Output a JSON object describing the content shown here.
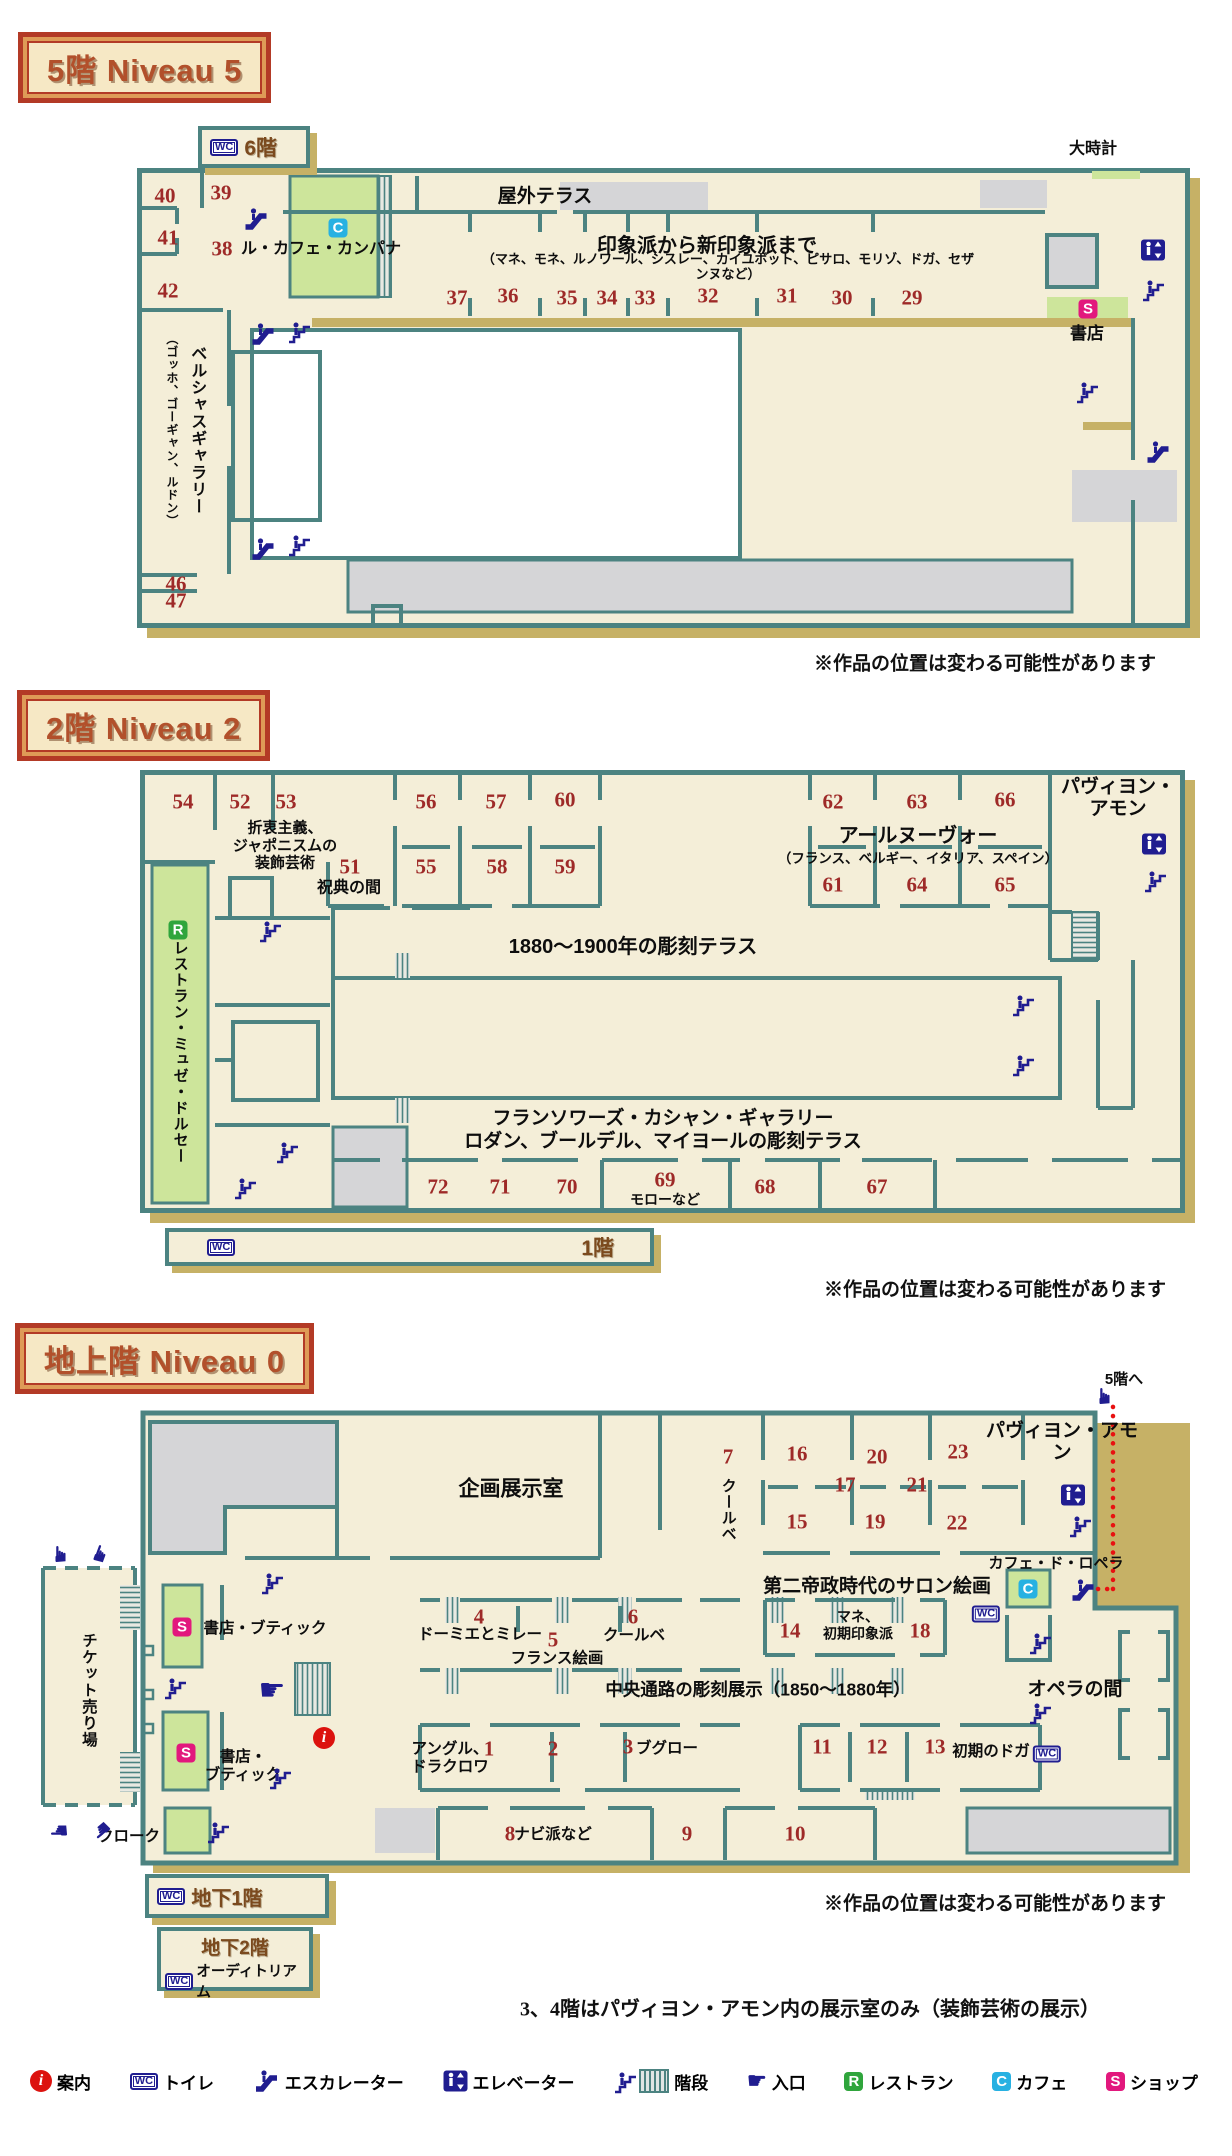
{
  "headers": {
    "f5": "5階 Niveau 5",
    "f2": "2階 Niveau 2",
    "f0": "地上階 Niveau 0"
  },
  "notes": {
    "works": "※作品の位置は変わる可能性があります",
    "footnote": "3、4階はパヴィヨン・アモン内の展示室のみ（装飾芸術の展示）"
  },
  "boxes": {
    "f6": "6階",
    "f1": "1階",
    "b1": "地下1階",
    "b2": "地下2階",
    "auditorium": "オーディトリアム"
  },
  "colors": {
    "teal": "#4c8381",
    "cream": "#f4eed8",
    "tan": "#c6b166",
    "gray": "#d5d5d7",
    "green": "#cde59b",
    "navy": "#201d90",
    "number": "#9e2a28",
    "shop": "#e2187d",
    "cafe": "#27b1e2",
    "restaurant": "#2fa53c",
    "info": "#dc120e",
    "route": "#e81111"
  },
  "legend": [
    {
      "icon": "info-icon",
      "label": "案内"
    },
    {
      "icon": "wc-icon",
      "label": "トイレ"
    },
    {
      "icon": "escalator-icon",
      "label": "エスカレーター"
    },
    {
      "icon": "elevator-icon",
      "label": "エレベーター"
    },
    {
      "icon": "stairs-hatch-icon",
      "label": "階段"
    },
    {
      "icon": "hand-icon",
      "label": "入口"
    },
    {
      "icon": "restaurant-badge",
      "label": "レストラン"
    },
    {
      "icon": "cafe-badge",
      "label": "カフェ"
    },
    {
      "icon": "shop-badge",
      "label": "ショップ"
    }
  ],
  "floors": [
    {
      "id": "niveau5",
      "items": [
        {
          "t": "num",
          "v": "40",
          "x": 165,
          "y": 196
        },
        {
          "t": "num",
          "v": "39",
          "x": 221,
          "y": 193
        },
        {
          "t": "num",
          "v": "41",
          "x": 168,
          "y": 238
        },
        {
          "t": "num",
          "v": "38",
          "x": 222,
          "y": 249
        },
        {
          "t": "num",
          "v": "42",
          "x": 168,
          "y": 291
        },
        {
          "t": "num",
          "v": "37",
          "x": 457,
          "y": 298
        },
        {
          "t": "num",
          "v": "36",
          "x": 508,
          "y": 296
        },
        {
          "t": "num",
          "v": "35",
          "x": 567,
          "y": 298
        },
        {
          "t": "num",
          "v": "34",
          "x": 607,
          "y": 298
        },
        {
          "t": "num",
          "v": "33",
          "x": 645,
          "y": 298
        },
        {
          "t": "num",
          "v": "32",
          "x": 708,
          "y": 296
        },
        {
          "t": "num",
          "v": "31",
          "x": 787,
          "y": 296
        },
        {
          "t": "num",
          "v": "30",
          "x": 842,
          "y": 298
        },
        {
          "t": "num",
          "v": "29",
          "x": 912,
          "y": 298
        },
        {
          "t": "num",
          "v": "46",
          "x": 176,
          "y": 584
        },
        {
          "t": "num",
          "v": "47",
          "x": 176,
          "y": 601
        },
        {
          "t": "lbl",
          "v": "大時計",
          "x": 1093,
          "y": 150,
          "fs": 16
        },
        {
          "t": "lbl",
          "v": "屋外テラス",
          "x": 545,
          "y": 197,
          "fs": 19
        },
        {
          "t": "lbl",
          "v": "印象派から新印象派まで",
          "x": 707,
          "y": 247,
          "fs": 20
        },
        {
          "t": "lbl",
          "v": "（マネ、モネ、ルノワール、シスレー、カイユボット、ピサロ、モリゾ、ドガ、セザンヌなど）",
          "x": 728,
          "y": 267,
          "fs": 13
        },
        {
          "t": "lbl",
          "v": "ル・カフェ・カンパナ",
          "x": 321,
          "y": 250,
          "fs": 16
        },
        {
          "t": "lbl",
          "v": "書店",
          "x": 1087,
          "y": 334,
          "fs": 17
        },
        {
          "t": "vlbl",
          "v": "ベルシャスギャラリー",
          "x": 196,
          "y": 430,
          "fs": 16
        },
        {
          "t": "vlbl",
          "v": "（ゴッホ、ゴーギャン、ルドン）",
          "x": 171,
          "y": 430,
          "fs": 12
        },
        {
          "t": "icon",
          "k": "escalator-icon",
          "x": 256,
          "y": 219
        },
        {
          "t": "icon",
          "k": "escalator-icon",
          "x": 263,
          "y": 334
        },
        {
          "t": "icon",
          "k": "stairs-icon",
          "x": 300,
          "y": 331
        },
        {
          "t": "icon",
          "k": "escalator-icon",
          "x": 263,
          "y": 549
        },
        {
          "t": "icon",
          "k": "stairs-icon",
          "x": 300,
          "y": 544
        },
        {
          "t": "icon",
          "k": "elevator-icon",
          "x": 1153,
          "y": 250
        },
        {
          "t": "icon",
          "k": "stairs-icon",
          "x": 1154,
          "y": 289
        },
        {
          "t": "icon",
          "k": "stairs-icon",
          "x": 1088,
          "y": 391
        },
        {
          "t": "icon",
          "k": "escalator-icon",
          "x": 1158,
          "y": 452
        },
        {
          "t": "badge",
          "v": "C",
          "x": 338,
          "y": 228
        },
        {
          "t": "badge",
          "v": "S",
          "x": 1088,
          "y": 309
        }
      ]
    },
    {
      "id": "niveau2",
      "items": [
        {
          "t": "num",
          "v": "54",
          "x": 183,
          "y": 802
        },
        {
          "t": "num",
          "v": "52",
          "x": 240,
          "y": 802
        },
        {
          "t": "num",
          "v": "53",
          "x": 286,
          "y": 802
        },
        {
          "t": "num",
          "v": "56",
          "x": 426,
          "y": 802
        },
        {
          "t": "num",
          "v": "57",
          "x": 496,
          "y": 802
        },
        {
          "t": "num",
          "v": "60",
          "x": 565,
          "y": 800
        },
        {
          "t": "num",
          "v": "51",
          "x": 350,
          "y": 867
        },
        {
          "t": "num",
          "v": "55",
          "x": 426,
          "y": 867
        },
        {
          "t": "num",
          "v": "58",
          "x": 497,
          "y": 867
        },
        {
          "t": "num",
          "v": "59",
          "x": 565,
          "y": 867
        },
        {
          "t": "num",
          "v": "62",
          "x": 833,
          "y": 802
        },
        {
          "t": "num",
          "v": "63",
          "x": 917,
          "y": 802
        },
        {
          "t": "num",
          "v": "66",
          "x": 1005,
          "y": 800
        },
        {
          "t": "num",
          "v": "61",
          "x": 833,
          "y": 885
        },
        {
          "t": "num",
          "v": "64",
          "x": 917,
          "y": 885
        },
        {
          "t": "num",
          "v": "65",
          "x": 1005,
          "y": 885
        },
        {
          "t": "num",
          "v": "72",
          "x": 438,
          "y": 1187
        },
        {
          "t": "num",
          "v": "71",
          "x": 500,
          "y": 1187
        },
        {
          "t": "num",
          "v": "70",
          "x": 567,
          "y": 1187
        },
        {
          "t": "num",
          "v": "69",
          "x": 665,
          "y": 1180
        },
        {
          "t": "num",
          "v": "68",
          "x": 765,
          "y": 1187
        },
        {
          "t": "num",
          "v": "67",
          "x": 877,
          "y": 1187
        },
        {
          "t": "lbl",
          "v": "折衷主義、\nジャポニスムの\n装飾芸術",
          "x": 285,
          "y": 846,
          "fs": 15
        },
        {
          "t": "lbl",
          "v": "祝典の間",
          "x": 349,
          "y": 889,
          "fs": 16
        },
        {
          "t": "lbl",
          "v": "アールヌーヴォー",
          "x": 918,
          "y": 837,
          "fs": 20
        },
        {
          "t": "lbl",
          "v": "（フランス、ベルギー、イタリア、スペイン）",
          "x": 918,
          "y": 859,
          "fs": 13.5
        },
        {
          "t": "lbl",
          "v": "パヴィヨン・アモン",
          "x": 1118,
          "y": 799,
          "fs": 19
        },
        {
          "t": "lbl",
          "v": "1880〜1900年の彫刻テラス",
          "x": 633,
          "y": 948,
          "fs": 20
        },
        {
          "t": "lbl",
          "v": "フランソワーズ・カシャン・ギャラリー",
          "x": 663,
          "y": 1119,
          "fs": 19
        },
        {
          "t": "lbl",
          "v": "ロダン、ブールデル、マイヨールの彫刻テラス",
          "x": 663,
          "y": 1142,
          "fs": 19
        },
        {
          "t": "lbl",
          "v": "モローなど",
          "x": 665,
          "y": 1200,
          "fs": 14
        },
        {
          "t": "vlbl",
          "v": "レストラン・ミュゼ・ドルセー",
          "x": 180,
          "y": 1052,
          "fs": 15
        },
        {
          "t": "icon",
          "k": "stairs-icon",
          "x": 271,
          "y": 930
        },
        {
          "t": "icon",
          "k": "elevator-icon",
          "x": 1154,
          "y": 844
        },
        {
          "t": "icon",
          "k": "stairs-icon",
          "x": 1156,
          "y": 880
        },
        {
          "t": "icon",
          "k": "stairs-icon",
          "x": 1024,
          "y": 1004
        },
        {
          "t": "icon",
          "k": "stairs-icon",
          "x": 1024,
          "y": 1064
        },
        {
          "t": "icon",
          "k": "stairs-icon",
          "x": 288,
          "y": 1151
        },
        {
          "t": "icon",
          "k": "stairs-icon",
          "x": 246,
          "y": 1187
        },
        {
          "t": "badge",
          "v": "R",
          "x": 178,
          "y": 930
        }
      ]
    },
    {
      "id": "niveau0",
      "items": [
        {
          "t": "num",
          "v": "7",
          "x": 728,
          "y": 1457
        },
        {
          "t": "num",
          "v": "16",
          "x": 797,
          "y": 1454
        },
        {
          "t": "num",
          "v": "17",
          "x": 845,
          "y": 1485
        },
        {
          "t": "num",
          "v": "15",
          "x": 797,
          "y": 1522
        },
        {
          "t": "num",
          "v": "20",
          "x": 877,
          "y": 1457
        },
        {
          "t": "num",
          "v": "21",
          "x": 917,
          "y": 1485
        },
        {
          "t": "num",
          "v": "19",
          "x": 875,
          "y": 1522
        },
        {
          "t": "num",
          "v": "23",
          "x": 958,
          "y": 1452
        },
        {
          "t": "num",
          "v": "22",
          "x": 957,
          "y": 1523
        },
        {
          "t": "num",
          "v": "4",
          "x": 479,
          "y": 1617
        },
        {
          "t": "num",
          "v": "5",
          "x": 553,
          "y": 1640
        },
        {
          "t": "num",
          "v": "6",
          "x": 633,
          "y": 1617
        },
        {
          "t": "num",
          "v": "14",
          "x": 790,
          "y": 1631
        },
        {
          "t": "num",
          "v": "18",
          "x": 920,
          "y": 1631
        },
        {
          "t": "num",
          "v": "1",
          "x": 489,
          "y": 1749
        },
        {
          "t": "num",
          "v": "2",
          "x": 553,
          "y": 1749
        },
        {
          "t": "num",
          "v": "3",
          "x": 628,
          "y": 1747
        },
        {
          "t": "num",
          "v": "11",
          "x": 822,
          "y": 1747
        },
        {
          "t": "num",
          "v": "12",
          "x": 877,
          "y": 1747
        },
        {
          "t": "num",
          "v": "13",
          "x": 935,
          "y": 1747
        },
        {
          "t": "num",
          "v": "8",
          "x": 510,
          "y": 1834
        },
        {
          "t": "num",
          "v": "9",
          "x": 687,
          "y": 1834
        },
        {
          "t": "num",
          "v": "10",
          "x": 795,
          "y": 1834
        },
        {
          "t": "lbl",
          "v": "企画展示室",
          "x": 511,
          "y": 1490,
          "fs": 21
        },
        {
          "t": "vlbl",
          "v": "クールベ",
          "x": 728,
          "y": 1510,
          "fs": 15
        },
        {
          "t": "lbl",
          "v": "パヴィヨン・アモン",
          "x": 1062,
          "y": 1443,
          "fs": 19
        },
        {
          "t": "lbl",
          "v": "5階へ",
          "x": 1124,
          "y": 1380,
          "fs": 15
        },
        {
          "t": "lbl",
          "v": "カフェ・ド・ロペラ",
          "x": 1056,
          "y": 1564,
          "fs": 15
        },
        {
          "t": "lbl",
          "v": "第二帝政時代のサロン絵画",
          "x": 877,
          "y": 1587,
          "fs": 19
        },
        {
          "t": "lbl",
          "v": "マネ、\n初期印象派",
          "x": 858,
          "y": 1625,
          "fs": 14
        },
        {
          "t": "lbl",
          "v": "中央通路の彫刻展示（1850〜1880年）",
          "x": 758,
          "y": 1690,
          "fs": 17.5
        },
        {
          "t": "lbl",
          "v": "オペラの間",
          "x": 1075,
          "y": 1690,
          "fs": 19
        },
        {
          "t": "lbl",
          "v": "ドーミエとミレー",
          "x": 480,
          "y": 1635,
          "fs": 15.5
        },
        {
          "t": "lbl",
          "v": "フランス絵画",
          "x": 557,
          "y": 1659,
          "fs": 15.5
        },
        {
          "t": "lbl",
          "v": "クールベ",
          "x": 634,
          "y": 1636,
          "fs": 15.5
        },
        {
          "t": "lbl",
          "v": "アングル、\nドラクロワ",
          "x": 450,
          "y": 1759,
          "fs": 15.5
        },
        {
          "t": "lbl",
          "v": "ブグロー",
          "x": 667,
          "y": 1749,
          "fs": 15.5
        },
        {
          "t": "lbl",
          "v": "初期のドガ",
          "x": 991,
          "y": 1752,
          "fs": 15.5
        },
        {
          "t": "lbl",
          "v": "ナビ派など",
          "x": 553,
          "y": 1835,
          "fs": 15.5
        },
        {
          "t": "lbl",
          "v": "書店・ブティック",
          "x": 265,
          "y": 1629,
          "fs": 15.5
        },
        {
          "t": "lbl",
          "v": "書店・\nブティック",
          "x": 243,
          "y": 1767,
          "fs": 15.5
        },
        {
          "t": "lbl",
          "v": "クローク",
          "x": 129,
          "y": 1837,
          "fs": 15.5
        },
        {
          "t": "vlbl",
          "v": "チケット売り場",
          "x": 88,
          "y": 1690,
          "fs": 15.5
        },
        {
          "t": "icon",
          "k": "stairs-icon",
          "x": 273,
          "y": 1582
        },
        {
          "t": "icon",
          "k": "stairs-icon",
          "x": 176,
          "y": 1687
        },
        {
          "t": "icon",
          "k": "hand-icon",
          "x": 272,
          "y": 1691,
          "rot": 0,
          "fs": 30
        },
        {
          "t": "icon",
          "k": "info-icon",
          "x": 324,
          "y": 1738
        },
        {
          "t": "icon",
          "k": "stairs-icon",
          "x": 281,
          "y": 1777
        },
        {
          "t": "icon",
          "k": "stairs-icon",
          "x": 219,
          "y": 1831
        },
        {
          "t": "icon",
          "k": "elevator-icon",
          "x": 1073,
          "y": 1495
        },
        {
          "t": "icon",
          "k": "stairs-icon",
          "x": 1081,
          "y": 1525
        },
        {
          "t": "icon",
          "k": "escalator-icon",
          "x": 1083,
          "y": 1590
        },
        {
          "t": "icon",
          "k": "wc-icon",
          "x": 986,
          "y": 1614
        },
        {
          "t": "icon",
          "k": "wc-icon",
          "x": 1047,
          "y": 1754
        },
        {
          "t": "icon",
          "k": "stairs-icon",
          "x": 1041,
          "y": 1642
        },
        {
          "t": "icon",
          "k": "stairs-icon",
          "x": 1041,
          "y": 1712
        },
        {
          "t": "icon",
          "k": "hand-icon",
          "x": 61,
          "y": 1554,
          "rot": -90
        },
        {
          "t": "icon",
          "k": "hand-icon",
          "x": 101,
          "y": 1554,
          "rot": -70
        },
        {
          "t": "icon",
          "k": "hand-icon",
          "x": 59,
          "y": 1830,
          "rot": 180
        },
        {
          "t": "icon",
          "k": "hand-icon",
          "x": 101,
          "y": 1830,
          "rot": 140
        },
        {
          "t": "icon",
          "k": "hand-icon",
          "x": 1105,
          "y": 1396,
          "rot": -90
        },
        {
          "t": "badge",
          "v": "S",
          "x": 182,
          "y": 1627
        },
        {
          "t": "badge",
          "v": "S",
          "x": 186,
          "y": 1753
        },
        {
          "t": "badge",
          "v": "C",
          "x": 1028,
          "y": 1589
        }
      ]
    }
  ]
}
